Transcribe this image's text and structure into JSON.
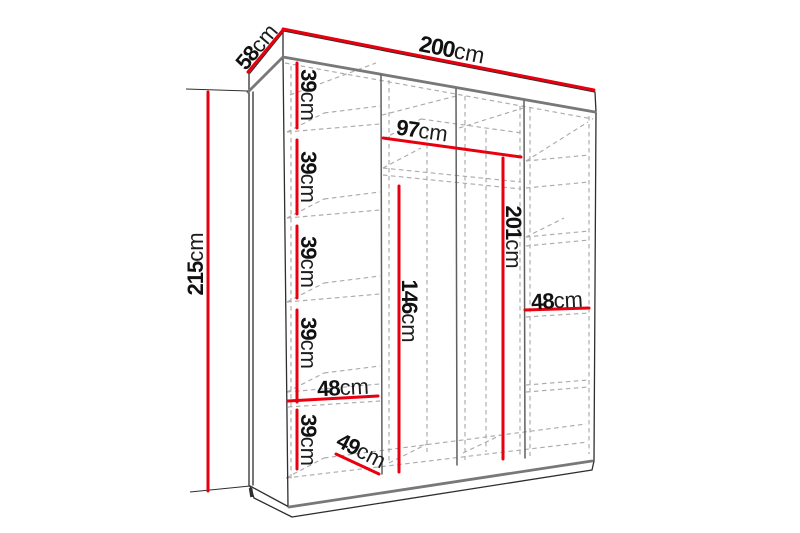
{
  "title": "Wardrobe interior dimensions diagram",
  "unit": "cm",
  "colors": {
    "dimension": "#e8000f",
    "outline": "#2e2e2e",
    "edge": "#787878",
    "partition": "#5f5f5f",
    "hidden": "#ababab",
    "background": "#ffffff"
  },
  "dims": [
    {
      "name": "total-width",
      "num": "200",
      "unit": "cm",
      "value": 200
    },
    {
      "name": "top-depth",
      "num": "58",
      "unit": "cm",
      "value": 58
    },
    {
      "name": "total-height",
      "num": "215",
      "unit": "cm",
      "value": 215
    },
    {
      "name": "shelf-gap-1",
      "num": "39",
      "unit": "cm",
      "value": 39
    },
    {
      "name": "shelf-gap-2",
      "num": "39",
      "unit": "cm",
      "value": 39
    },
    {
      "name": "shelf-gap-3",
      "num": "39",
      "unit": "cm",
      "value": 39
    },
    {
      "name": "shelf-gap-4",
      "num": "39",
      "unit": "cm",
      "value": 39
    },
    {
      "name": "shelf-gap-5",
      "num": "39",
      "unit": "cm",
      "value": 39
    },
    {
      "name": "middle-section-width",
      "num": "97",
      "unit": "cm",
      "value": 97
    },
    {
      "name": "interior-height",
      "num": "201",
      "unit": "cm",
      "value": 201
    },
    {
      "name": "hanging-space-height",
      "num": "146",
      "unit": "cm",
      "value": 146
    },
    {
      "name": "left-shelf-width",
      "num": "48",
      "unit": "cm",
      "value": 48
    },
    {
      "name": "right-shelf-width",
      "num": "48",
      "unit": "cm",
      "value": 48
    },
    {
      "name": "interior-depth",
      "num": "49",
      "unit": "cm",
      "value": 49
    }
  ]
}
